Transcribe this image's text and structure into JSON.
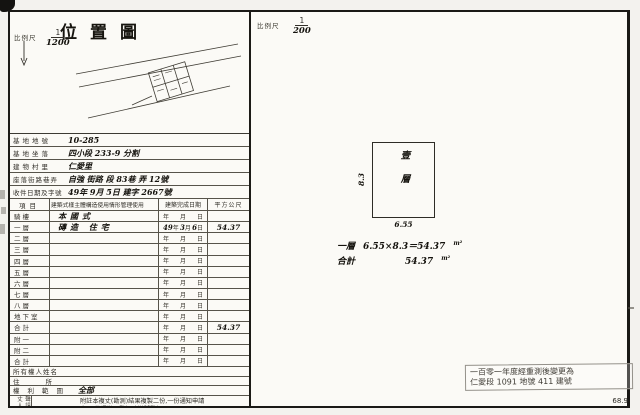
{
  "left": {
    "title": "位置圖",
    "scale_label": "比例尺",
    "scale": {
      "num": "1",
      "den": "1200"
    }
  },
  "form": {
    "info_rows": [
      {
        "label": "基地地號",
        "value": "10-285"
      },
      {
        "label": "基地坐落",
        "value": "四小段 233-9 分割"
      },
      {
        "label": "建物村里",
        "value": "仁愛里"
      },
      {
        "label": "座落街路巷弄",
        "value": "自強 街路 段 83巷 弄 12號"
      },
      {
        "label": "收件日期及字號",
        "value": "49年 9月 5日 建字 2667號"
      }
    ],
    "header": {
      "item": "項目",
      "desc": "建築式樣主體構造使用情形管理使用",
      "date": "建築完成日期",
      "area": "平方公尺"
    },
    "date_units": {
      "y": "年",
      "m": "月",
      "d": "日"
    },
    "floor_rows": [
      {
        "label": "騎樓",
        "desc": "本國式",
        "dy": "",
        "dm": "",
        "dd": "",
        "area": ""
      },
      {
        "label": "一層",
        "desc": "磚造 住宅",
        "dy": "49",
        "dm": "3",
        "dd": "6",
        "area": "54.37"
      },
      {
        "label": "二層",
        "desc": "",
        "dy": "",
        "dm": "",
        "dd": "",
        "area": ""
      },
      {
        "label": "三層",
        "desc": "",
        "dy": "",
        "dm": "",
        "dd": "",
        "area": ""
      },
      {
        "label": "四層",
        "desc": "",
        "dy": "",
        "dm": "",
        "dd": "",
        "area": ""
      },
      {
        "label": "五層",
        "desc": "",
        "dy": "",
        "dm": "",
        "dd": "",
        "area": ""
      },
      {
        "label": "六層",
        "desc": "",
        "dy": "",
        "dm": "",
        "dd": "",
        "area": ""
      },
      {
        "label": "七層",
        "desc": "",
        "dy": "",
        "dm": "",
        "dd": "",
        "area": ""
      },
      {
        "label": "八層",
        "desc": "",
        "dy": "",
        "dm": "",
        "dd": "",
        "area": ""
      },
      {
        "label": "地下室",
        "desc": "",
        "dy": "",
        "dm": "",
        "dd": "",
        "area": ""
      },
      {
        "label": "合計",
        "desc": "",
        "dy": "",
        "dm": "",
        "dd": "",
        "area": "54.37"
      },
      {
        "label": "附一",
        "desc": "",
        "dy": "",
        "dm": "",
        "dd": "",
        "area": ""
      },
      {
        "label": "附二",
        "desc": "",
        "dy": "",
        "dm": "",
        "dd": "",
        "area": ""
      },
      {
        "label": "合計",
        "desc": "",
        "dy": "",
        "dm": "",
        "dd": "",
        "area": ""
      }
    ],
    "owner_rows": [
      {
        "label": "所有權人姓名",
        "value": ""
      },
      {
        "label": "住所",
        "value": ""
      },
      {
        "label": "權利範圍",
        "value": "全部"
      }
    ],
    "note": {
      "side_label": "聲請複丈人章",
      "line1": "附註本複丈(勘測)結果複製二份,一份通知申請",
      "line2": "人,一份憑變更登記時掛號登記"
    }
  },
  "right": {
    "scale_label": "比例尺",
    "scale": {
      "num": "1",
      "den": "200"
    },
    "plan": {
      "room": "壹層",
      "dim_left": "8.3",
      "dim_bottom": "6.55"
    },
    "calc_rows": [
      {
        "label": "一層",
        "expr": "6.55×8.3＝54.37",
        "unit": "m²"
      },
      {
        "label": "合計",
        "expr": "54.37",
        "unit": "m²"
      }
    ],
    "stamp": {
      "line1": "一百零一年度經重測後變更為",
      "line2": "仁愛段 1091 地號 411 建號"
    },
    "page_code": "68.9"
  },
  "colors": {
    "ink": "#1a1916",
    "paper": "#fbfaf6",
    "stamp_border": "#94918a"
  }
}
